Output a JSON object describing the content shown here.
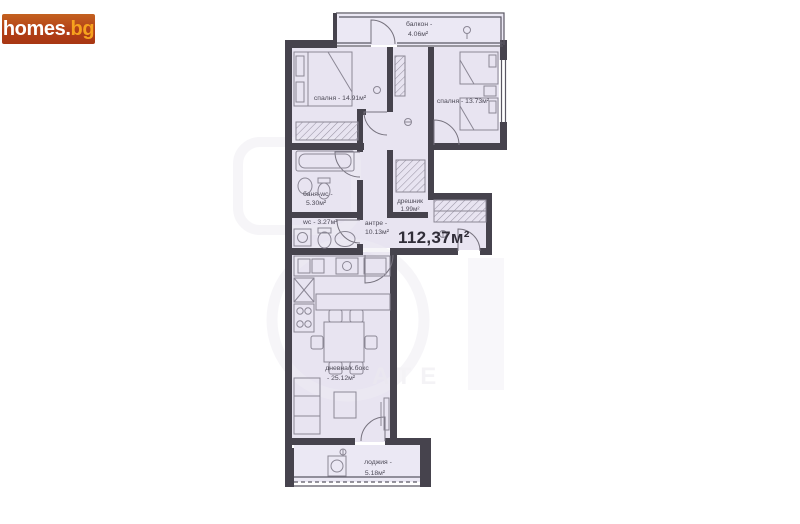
{
  "logo": {
    "main": "homes",
    "dot": ".",
    "tld": "bg",
    "bg_color": "#b2441b",
    "main_color": "#ffffff",
    "tld_color": "#f6a21e"
  },
  "floorplan": {
    "wall_color": "#46434d",
    "room_fill_color": "#e8e4f1",
    "furniture_color": "#8b8795",
    "label_color": "#4d4a57",
    "total_area": {
      "label": "112,37м²"
    },
    "rooms": [
      {
        "name": "balcony",
        "line1": "балкон -",
        "line2": "4.06м²"
      },
      {
        "name": "bedroom-left",
        "line1": "спалня - 14.91м²"
      },
      {
        "name": "bedroom-right",
        "line1": "спалня - 13.73м²"
      },
      {
        "name": "bathroom",
        "line1": "баня-wc -",
        "line2": "5.30м²"
      },
      {
        "name": "wc",
        "line1": "wc - 3.27м²"
      },
      {
        "name": "closet",
        "line1": "дрешник",
        "line2": "1.99м²"
      },
      {
        "name": "hallway",
        "line1": "антре -",
        "line2": "10.13м²"
      },
      {
        "name": "living-kitchen",
        "line1": "дневна/к.бокс",
        "line2": "- 25.12м²"
      },
      {
        "name": "loggia",
        "line1": "лоджия -",
        "line2": "5.18м²"
      }
    ]
  },
  "watermark": {
    "text": "ATE"
  }
}
